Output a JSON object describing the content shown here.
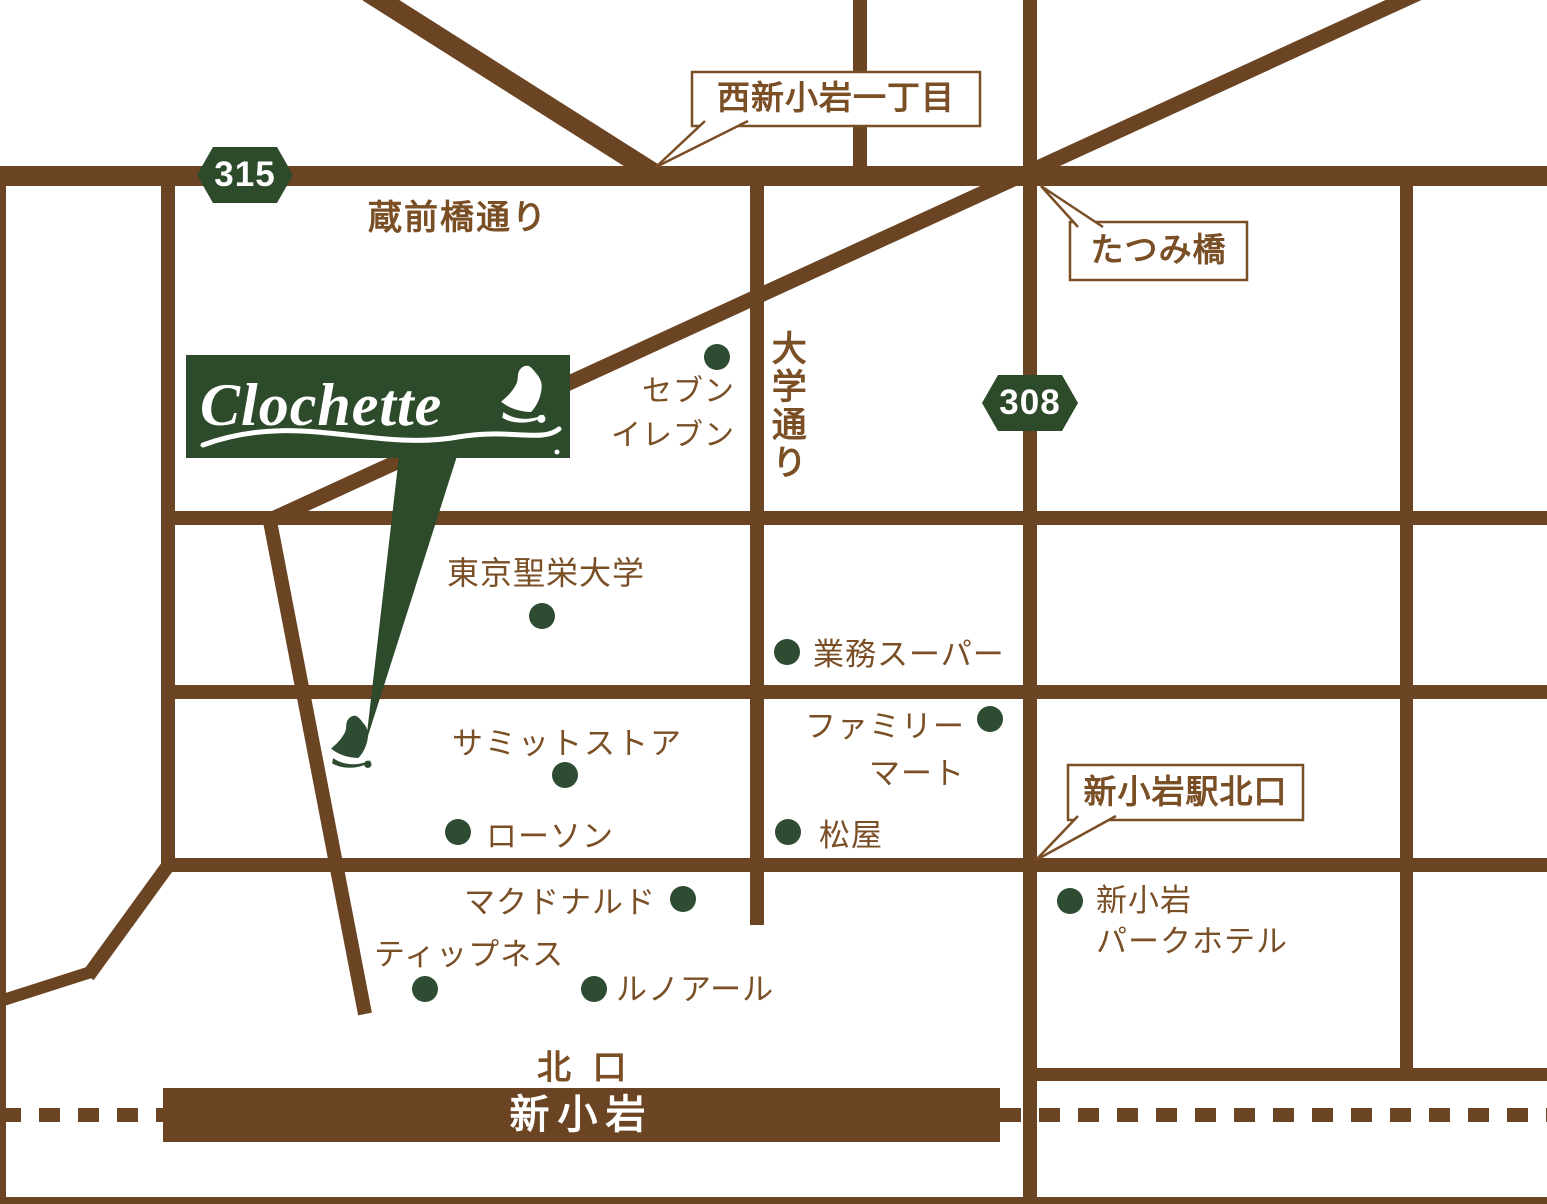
{
  "colors": {
    "road_brown": "#6b4423",
    "text_brown": "#7a4f26",
    "accent_green": "#2d4a2b",
    "dot_green": "#2d4c31",
    "white": "#ffffff"
  },
  "logo": {
    "name": "Clochette"
  },
  "badges": {
    "route_315": "315",
    "route_308": "308"
  },
  "streets": {
    "kuramaebashi_dori": "蔵前橋通り",
    "daigaku_dori": "大学通り"
  },
  "callouts": {
    "nishi_shinkoiwa_1chome": "西新小岩一丁目",
    "tatsumibashi": "たつみ橋",
    "shinkoiwa_north_exit": "新小岩駅北口"
  },
  "landmarks": {
    "seven_eleven": {
      "line1": "セブン",
      "line2": "イレブン"
    },
    "tokyo_seiei_univ": {
      "label": "東京聖栄大学"
    },
    "gyomu_super": {
      "label": "業務スーパー"
    },
    "summit_store": {
      "label": "サミットストア"
    },
    "family_mart": {
      "line1": "ファミリー",
      "line2": "マート"
    },
    "lawson": {
      "label": "ローソン"
    },
    "matsuya": {
      "label": "松屋"
    },
    "mcdonalds": {
      "label": "マクドナルド"
    },
    "shinkoiwa_park_hotel": {
      "line1": "新小岩",
      "line2": "パークホテル"
    },
    "tipness": {
      "label": "ティップネス"
    },
    "renoir": {
      "label": "ルノアール"
    }
  },
  "station": {
    "north_exit_label": "北 口",
    "station_name": "新小岩"
  }
}
